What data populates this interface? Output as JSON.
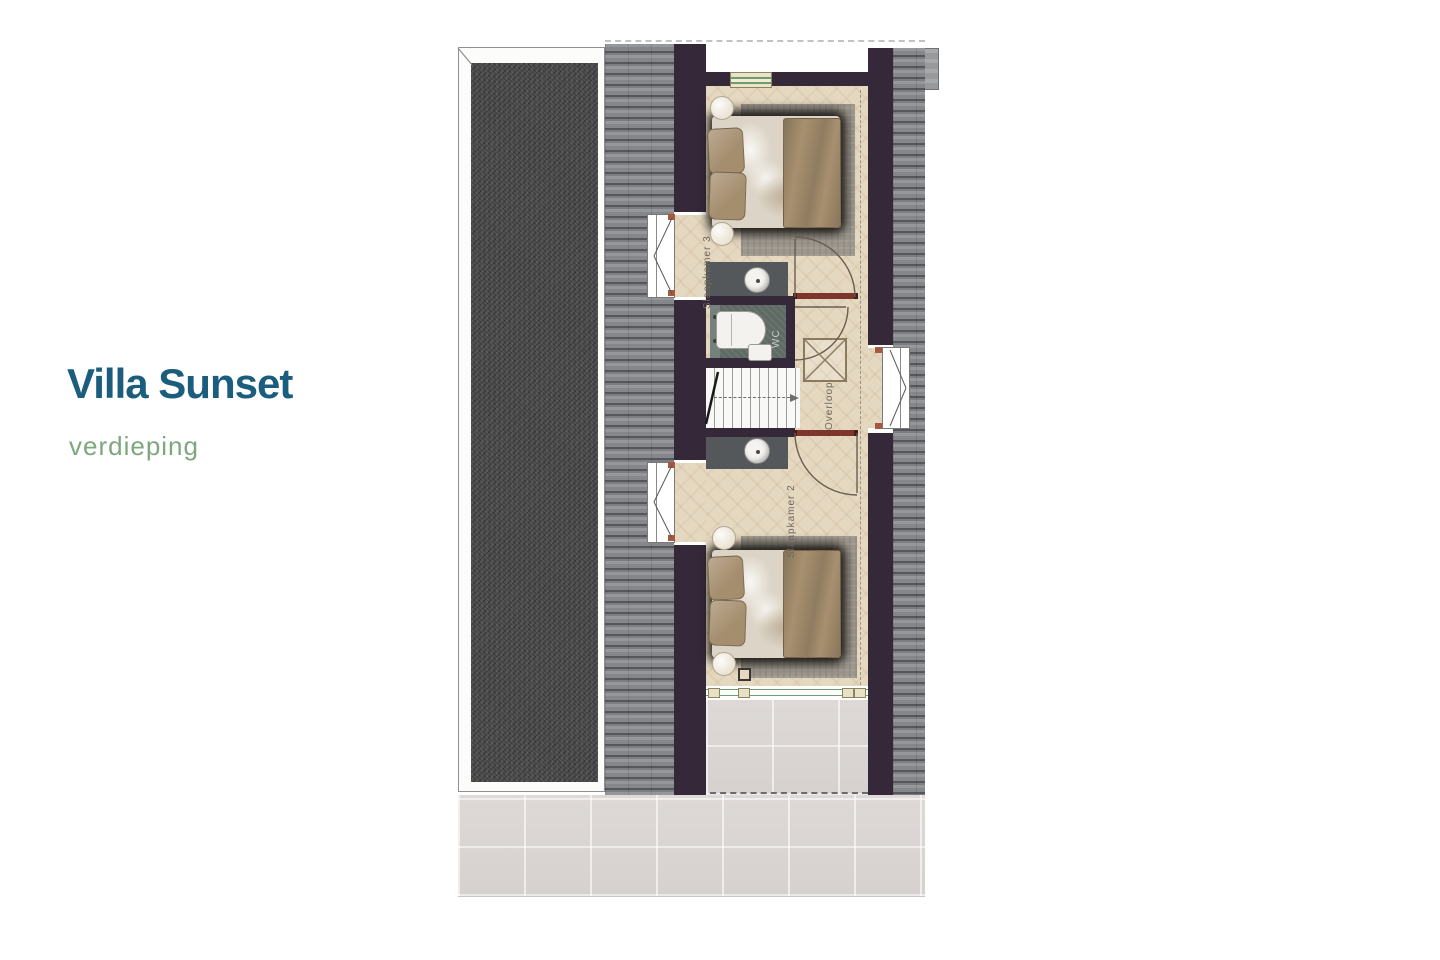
{
  "title_block": {
    "title": "Villa Sunset",
    "subtitle": "verdieping",
    "title_color": "#1b5d7c",
    "subtitle_color": "#7fa77d"
  },
  "floor_plan": {
    "rooms": {
      "bedroom3_label": "Slaapkamer 3",
      "bedroom2_label": "Slaapkamer 2",
      "landing_label": "Overloop",
      "wc_label": "WC"
    },
    "colors": {
      "wall": "#342839",
      "floor_parquet": "#e5d8c0",
      "pitched_roof": "#85878a",
      "flat_roof": "#474747",
      "terrace_tile": "#dcd7d5",
      "door_marker_red": "#7d352c",
      "wc_floor": "#5e6a63",
      "counter": "#54585a",
      "window_green": "#6f9b6e",
      "bed_textile": "#a7906f"
    }
  }
}
